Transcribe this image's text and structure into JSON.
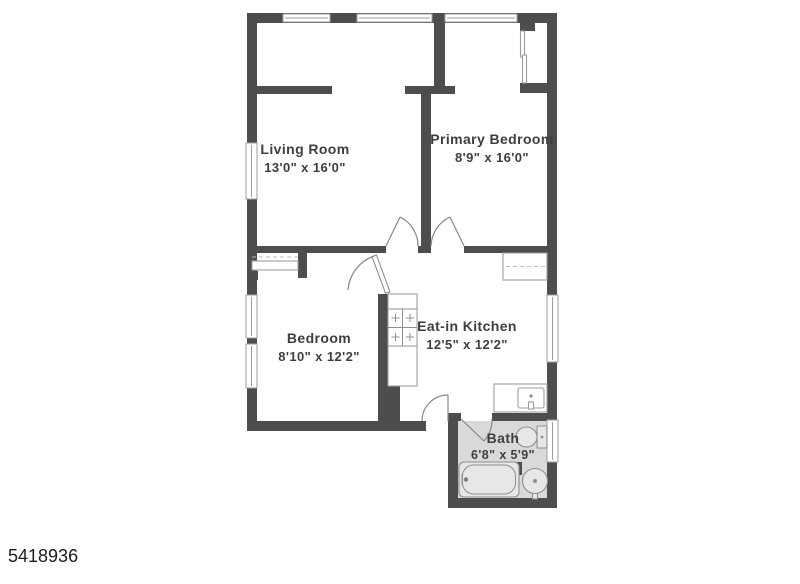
{
  "listing_id": "5418936",
  "floor_plan": {
    "rooms": [
      {
        "id": "living-room",
        "name": "Living Room",
        "dimensions": "13'0\" x 16'0\""
      },
      {
        "id": "primary-bedroom",
        "name": "Primary Bedroom",
        "dimensions": "8'9\" x 16'0\""
      },
      {
        "id": "bedroom",
        "name": "Bedroom",
        "dimensions": "8'10\" x 12'2\""
      },
      {
        "id": "eat-in-kitchen",
        "name": "Eat-in Kitchen",
        "dimensions": "12'5\" x 12'2\""
      },
      {
        "id": "bath",
        "name": "Bath",
        "dimensions": "6'8\" x 5'9\""
      }
    ],
    "colors": {
      "background": "#ffffff",
      "wall": "#4d4d4d",
      "bath_floor": "#d9d9d9",
      "fixture_outline": "#9e9e9e",
      "label_text": "#3e3e3e",
      "id_text": "#1c1c1c"
    }
  }
}
